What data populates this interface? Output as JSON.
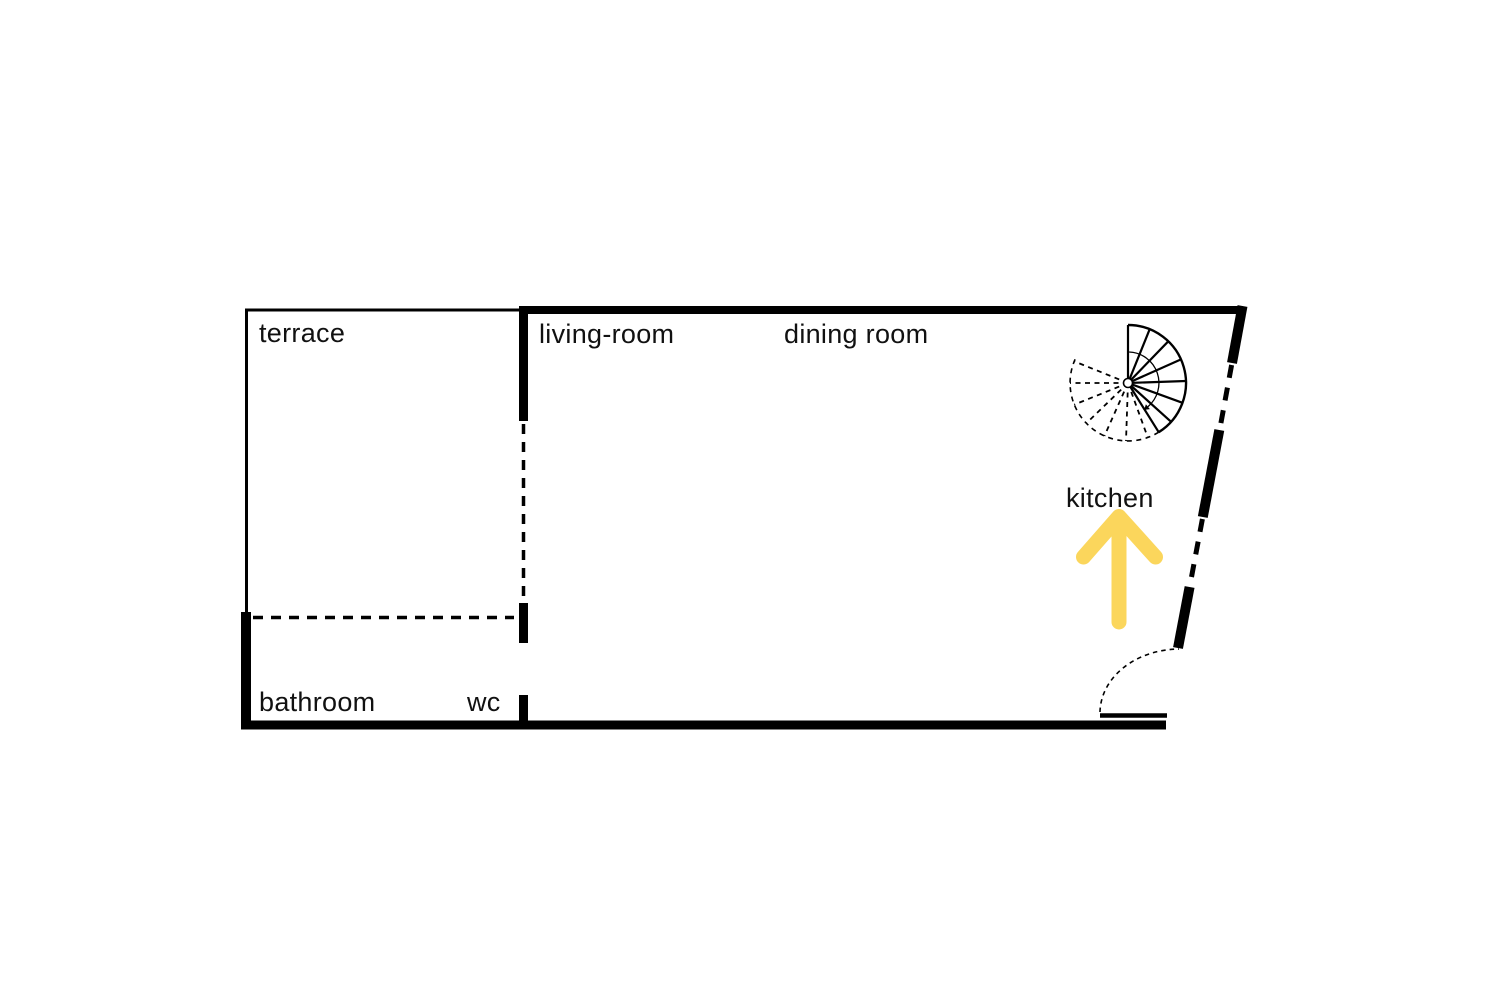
{
  "colors": {
    "wall": "#000000",
    "text": "#111111",
    "arrow": "#FBD65C",
    "background": "#FFFFFF"
  },
  "rooms": {
    "terrace": {
      "label": "terrace"
    },
    "living_room": {
      "label": "living-room"
    },
    "dining_room": {
      "label": "dining room"
    },
    "kitchen": {
      "label": "kitchen"
    },
    "bathroom": {
      "label": "bathroom"
    },
    "wc": {
      "label": "wc"
    }
  },
  "symbols": {
    "staircase": "spiral-staircase-icon",
    "kitchen_arrow": "up-arrow-icon",
    "entry_door": "door-swing-arc-icon"
  }
}
